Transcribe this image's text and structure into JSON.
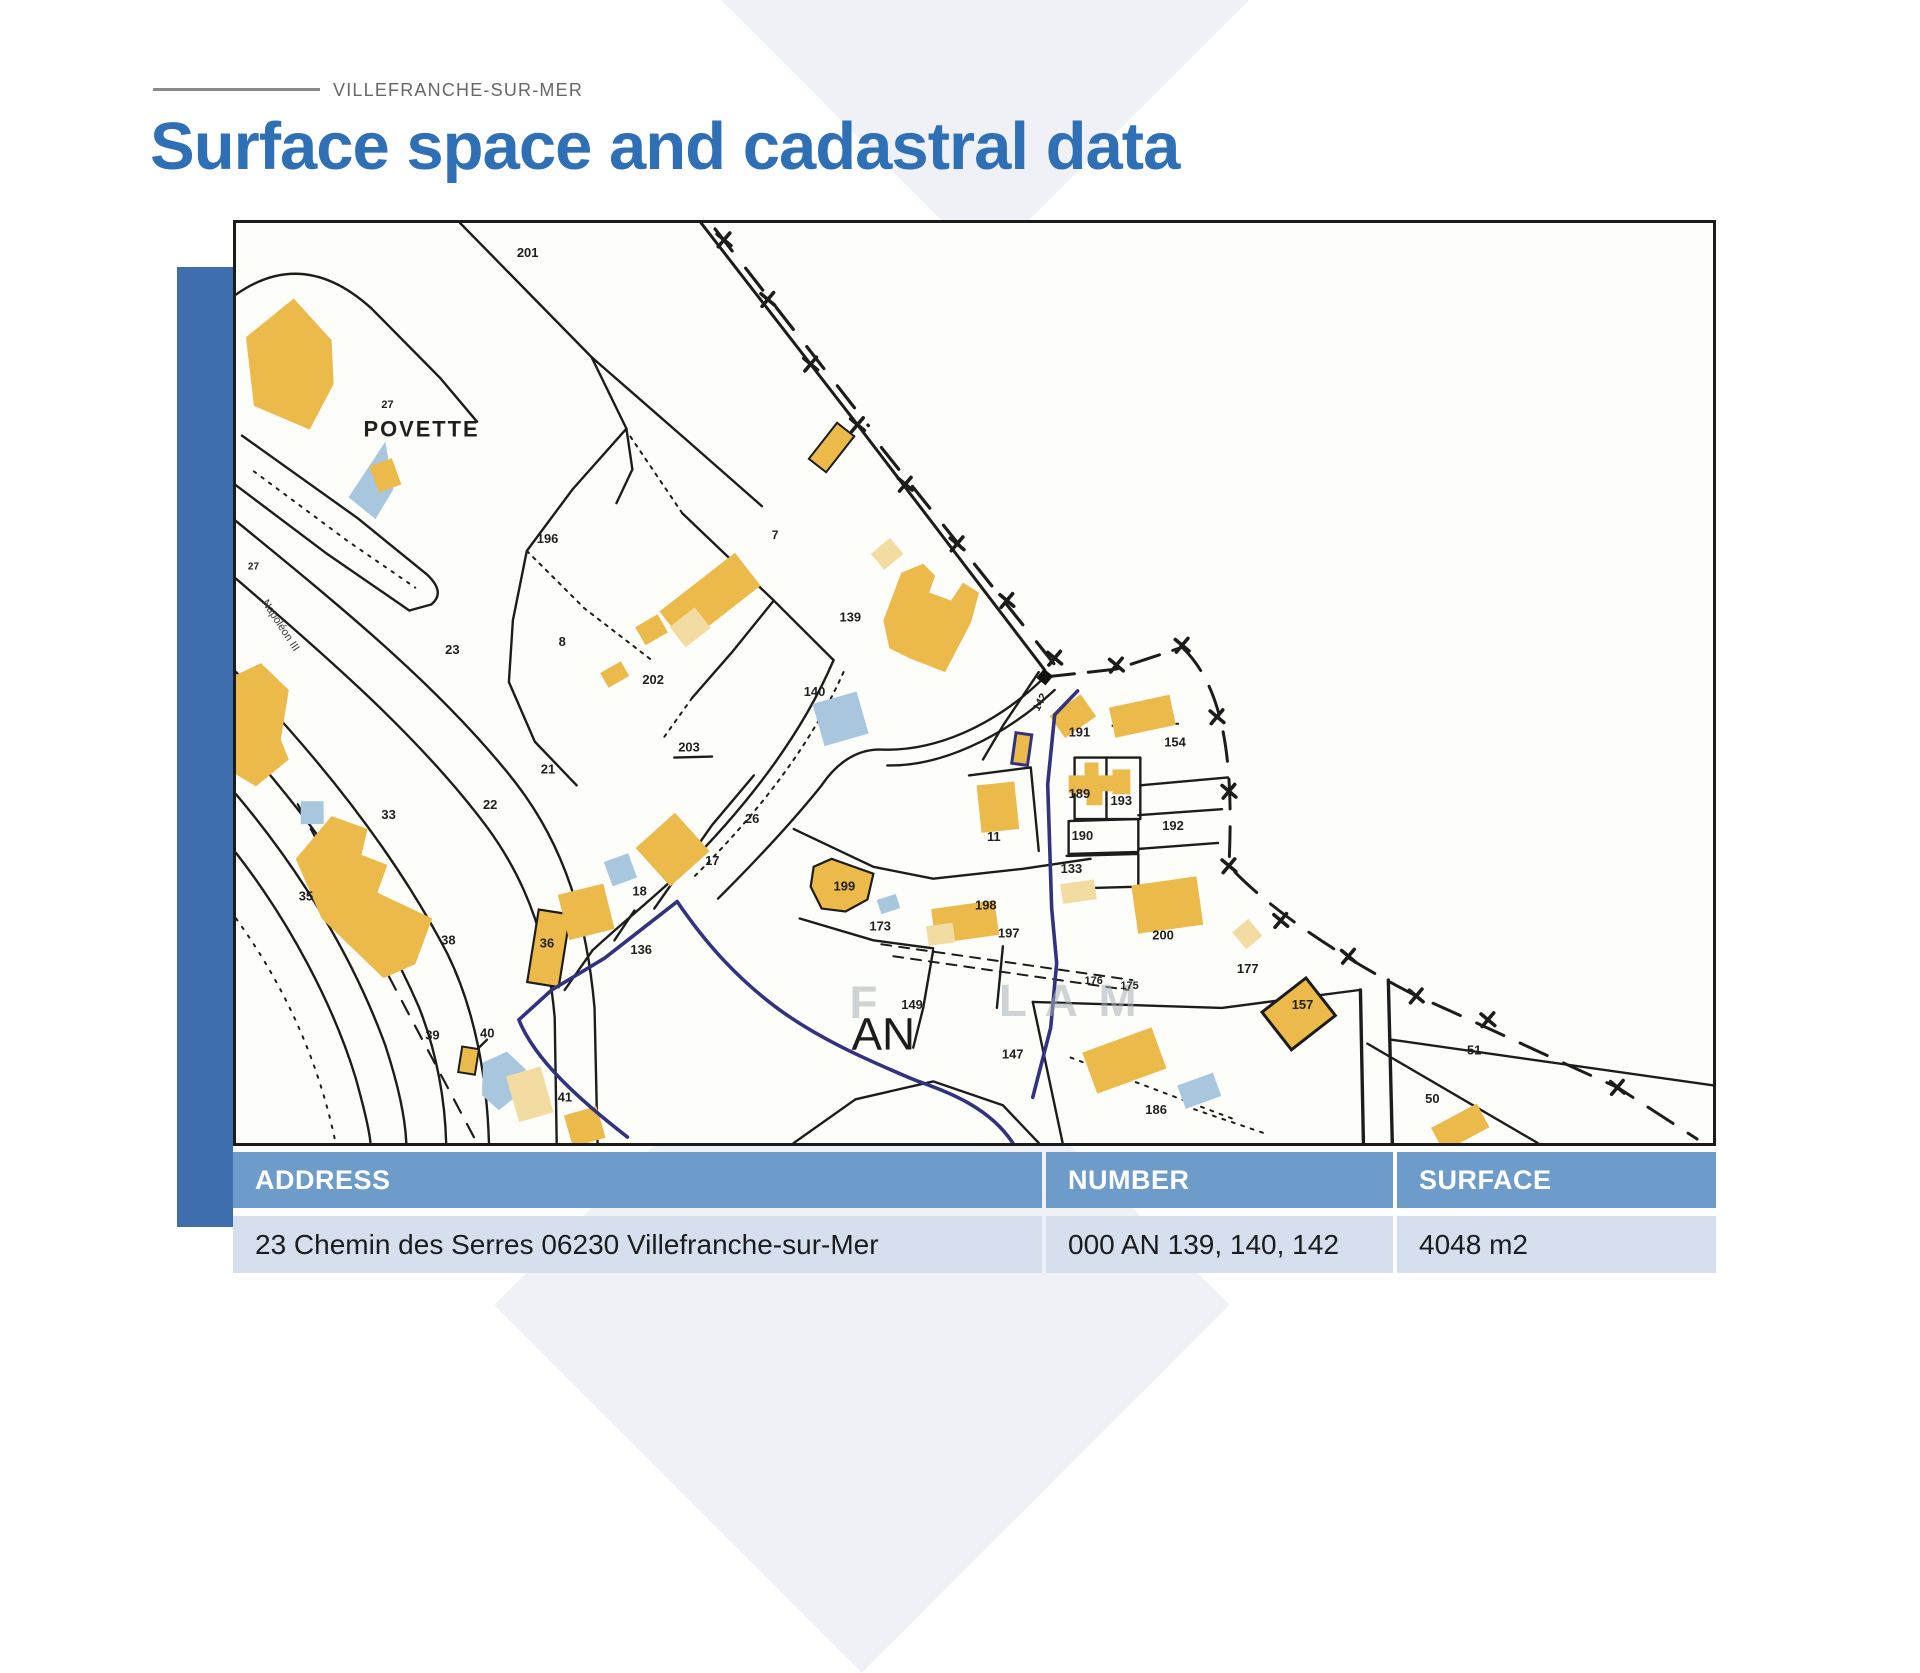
{
  "header": {
    "eyebrow": "VILLEFRANCHE-SUR-MER",
    "title": "Surface space and cadastral data"
  },
  "map": {
    "region_code": "AN",
    "place_name": "POVETTE",
    "street_name": "Napoléon III",
    "labels": [
      {
        "t": "201",
        "x": 282,
        "y": 34
      },
      {
        "t": "27",
        "x": 146,
        "y": 186,
        "s": 11
      },
      {
        "t": "7",
        "x": 538,
        "y": 318,
        "s": 12
      },
      {
        "t": "139",
        "x": 606,
        "y": 401
      },
      {
        "t": "140",
        "x": 570,
        "y": 476
      },
      {
        "t": "202",
        "x": 408,
        "y": 464
      },
      {
        "t": "203",
        "x": 444,
        "y": 532
      },
      {
        "t": "196",
        "x": 302,
        "y": 322
      },
      {
        "t": "23",
        "x": 210,
        "y": 434
      },
      {
        "t": "8",
        "x": 324,
        "y": 426
      },
      {
        "t": "21",
        "x": 306,
        "y": 554
      },
      {
        "t": "22",
        "x": 248,
        "y": 590
      },
      {
        "t": "33",
        "x": 146,
        "y": 600
      },
      {
        "t": "35",
        "x": 63,
        "y": 682
      },
      {
        "t": "38",
        "x": 206,
        "y": 726
      },
      {
        "t": "36",
        "x": 305,
        "y": 729
      },
      {
        "t": "39",
        "x": 190,
        "y": 822
      },
      {
        "t": "40",
        "x": 245,
        "y": 820
      },
      {
        "t": "41",
        "x": 323,
        "y": 884
      },
      {
        "t": "136",
        "x": 396,
        "y": 736
      },
      {
        "t": "18",
        "x": 398,
        "y": 677
      },
      {
        "t": "17",
        "x": 471,
        "y": 646
      },
      {
        "t": "26",
        "x": 511,
        "y": 604
      },
      {
        "t": "199",
        "x": 600,
        "y": 672
      },
      {
        "t": "173",
        "x": 636,
        "y": 712
      },
      {
        "t": "198",
        "x": 742,
        "y": 691
      },
      {
        "t": "197",
        "x": 765,
        "y": 719
      },
      {
        "t": "11",
        "x": 754,
        "y": 622
      },
      {
        "t": "189",
        "x": 836,
        "y": 579
      },
      {
        "t": "193",
        "x": 878,
        "y": 586
      },
      {
        "t": "190",
        "x": 839,
        "y": 621
      },
      {
        "t": "133",
        "x": 828,
        "y": 654
      },
      {
        "t": "191",
        "x": 836,
        "y": 517
      },
      {
        "t": "154",
        "x": 932,
        "y": 527
      },
      {
        "t": "192",
        "x": 930,
        "y": 611
      },
      {
        "t": "200",
        "x": 920,
        "y": 721
      },
      {
        "t": "177",
        "x": 1005,
        "y": 755
      },
      {
        "t": "157",
        "x": 1060,
        "y": 791
      },
      {
        "t": "176",
        "x": 852,
        "y": 766,
        "s": 11
      },
      {
        "t": "175",
        "x": 888,
        "y": 771,
        "s": 11
      },
      {
        "t": "149",
        "x": 668,
        "y": 791
      },
      {
        "t": "147",
        "x": 769,
        "y": 841
      },
      {
        "t": "186",
        "x": 913,
        "y": 897
      },
      {
        "t": "51",
        "x": 1236,
        "y": 837
      },
      {
        "t": "50",
        "x": 1194,
        "y": 886
      },
      {
        "t": "142",
        "x": 806,
        "y": 492,
        "r": -62,
        "s": 11
      },
      {
        "t": "27",
        "x": 12,
        "y": 349,
        "s": 10
      }
    ],
    "crosses": [
      [
        490,
        17
      ],
      [
        534,
        77
      ],
      [
        577,
        142
      ],
      [
        624,
        203
      ],
      [
        672,
        263
      ],
      [
        724,
        323
      ],
      [
        774,
        380
      ],
      [
        822,
        438
      ],
      [
        884,
        445
      ],
      [
        950,
        425
      ],
      [
        985,
        497
      ],
      [
        997,
        572
      ],
      [
        997,
        647
      ],
      [
        1049,
        702
      ],
      [
        1117,
        738
      ],
      [
        1185,
        778
      ],
      [
        1257,
        802
      ],
      [
        1387,
        870
      ]
    ],
    "watermark_letters": [
      {
        "c": "F",
        "x": 616,
        "y": 800
      },
      {
        "c": "L",
        "x": 766,
        "y": 798
      },
      {
        "c": "A",
        "x": 812,
        "y": 798
      },
      {
        "c": "M",
        "x": 866,
        "y": 798
      }
    ]
  },
  "table": {
    "columns": [
      "ADDRESS",
      "NUMBER",
      "SURFACE"
    ],
    "rows": [
      [
        "23 Chemin des Serres 06230 Villefranche-sur-Mer",
        "000 AN 139, 140, 142",
        "4048 m2"
      ]
    ]
  },
  "colors": {
    "accent_blue": "#2e6fb5",
    "bar_blue": "#3e6ead",
    "table_header_blue": "#6d9ccb",
    "table_row_blue": "#d5dfed",
    "building_yellow": "#ecb94b",
    "building_pale_yellow": "#f3dca1",
    "pool_blue": "#a9c6df",
    "cadastral_outline_navy": "#32327e"
  }
}
